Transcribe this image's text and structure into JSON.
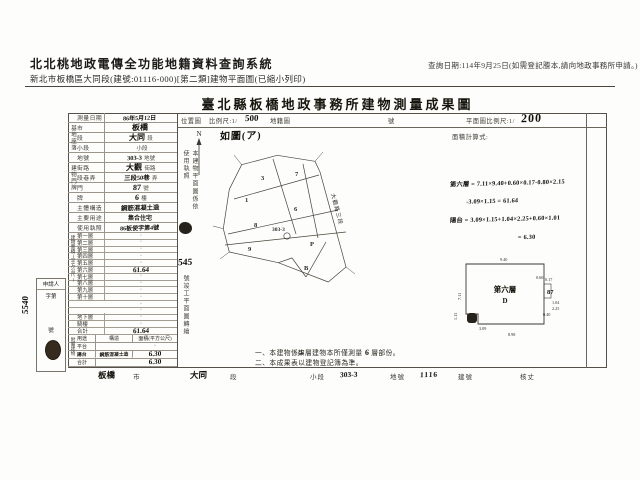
{
  "page": {
    "system_title": "北北桃地政電傳全功能地籍資料查詢系統",
    "query_date": "查詢日期:114年9月25日(如需登記謄本,請向地政事務所申請。)",
    "subtitle": "新北市板橋區大同段(建號:01116-000)[第二類]建物平面圖(已縮小列印)"
  },
  "form": {
    "title": "臺北縣板橋地政事務所建物測量成果圖",
    "header": {
      "location_map": "位置圖",
      "scale_label": "比例尺:1/",
      "scale_value": "500",
      "cadastral_label": "地籍圖",
      "sheet_label": "號",
      "plan_scale_label": "平面圖比例尺:1/",
      "plan_scale_value": "200",
      "calc_label": "面積計算式:"
    }
  },
  "left_table": {
    "groups": {
      "site": "基地座落",
      "door": "建物門牌",
      "area": "建物面積(平方公尺)",
      "annex": "附屬建物"
    },
    "main_rows": [
      {
        "label": "測量日期",
        "value": "86年5月12日",
        "suffix": "",
        "vcls": "hws"
      },
      {
        "label": "市",
        "value": "板橋",
        "suffix": "",
        "vcls": "hw"
      },
      {
        "label": "段",
        "value": "大同",
        "suffix": "段",
        "vcls": "hw"
      },
      {
        "label": "小段",
        "value": "",
        "suffix": "小段",
        "vcls": "hws"
      },
      {
        "label": "地號",
        "value": "303-3",
        "suffix": "地號",
        "vcls": "hwm"
      },
      {
        "label": "街路",
        "value": "大觀",
        "suffix": "街路",
        "vcls": "hw"
      },
      {
        "label": "段巷弄",
        "value": "三段50巷",
        "suffix": "弄",
        "vcls": "hwm"
      },
      {
        "label": "門",
        "value": "87",
        "suffix": "號",
        "vcls": "hw"
      },
      {
        "label": "牌",
        "value": "6",
        "suffix": "樓",
        "vcls": "hw"
      },
      {
        "label": "主體構造",
        "value": "鋼筋混凝土造",
        "suffix": "",
        "vcls": "hwm"
      },
      {
        "label": "主要用途",
        "value": "集合住宅",
        "suffix": "",
        "vcls": "pr2"
      },
      {
        "label": "使用執照",
        "value": "86板使字第4號",
        "suffix": "",
        "vcls": "hws"
      }
    ],
    "floor_rows": [
      {
        "label": "第一層",
        "value": "·",
        "vcls": "dot"
      },
      {
        "label": "第二層",
        "value": "·",
        "vcls": "dot"
      },
      {
        "label": "第三層",
        "value": "·",
        "vcls": "dot"
      },
      {
        "label": "第四層",
        "value": "·",
        "vcls": "dot"
      },
      {
        "label": "第五層",
        "value": "·",
        "vcls": "dot"
      },
      {
        "label": "第六層",
        "value": "61.64",
        "vcls": "hwv"
      },
      {
        "label": "第七層",
        "value": "·",
        "vcls": "dot"
      },
      {
        "label": "第八層",
        "value": "·",
        "vcls": "dot"
      },
      {
        "label": "第九層",
        "value": "·",
        "vcls": "dot"
      },
      {
        "label": "第十層",
        "value": "·",
        "vcls": "dot"
      },
      {
        "label": "",
        "value": "·",
        "vcls": "dot"
      },
      {
        "label": "",
        "value": "·",
        "vcls": "dot"
      },
      {
        "label": "地下層",
        "value": "·",
        "vcls": "dot"
      },
      {
        "label": "騎樓",
        "value": "·",
        "vcls": "dot"
      },
      {
        "label": "合計",
        "value": "61.64",
        "vcls": "hwv"
      }
    ],
    "annex_header": {
      "use": "用途",
      "struct": "構造",
      "area": "面積(平方公尺)"
    },
    "annex_rows": [
      {
        "use": "平台",
        "struct": "",
        "area": "·",
        "ucls": "pr",
        "acls": "dot"
      },
      {
        "use": "陽台",
        "struct": "鋼筋混凝土造",
        "area": "6.30",
        "ucls": "hwt",
        "acls": "hwv"
      },
      {
        "use": "合計",
        "struct": "",
        "area": "6.30",
        "ucls": "pr",
        "acls": "hwv"
      }
    ]
  },
  "map": {
    "north": "N",
    "sketch_note": "如圖(ア)",
    "street": "大觀路三段",
    "subject_parcel": "303-3",
    "parcels": [
      "3",
      "7",
      "1",
      "6",
      "8",
      "303-3",
      "9",
      "P",
      "B"
    ]
  },
  "calc": {
    "line1": "第六層 = 7.11×9.40+0.60×0.17-0.80×2.15",
    "line2": "-3.09×1.15 = 61.64",
    "line3": "陽台 = 3.09×1.15+1.04×2.25+0.60×1.01",
    "line4": "= 6.30"
  },
  "plan": {
    "floor": "第六層",
    "unit": "D",
    "house_no": "87",
    "dim_top": "9.40",
    "dim_left": "7.11",
    "dim_bottom": "8.98",
    "d1": "0.17",
    "d2": "1.04",
    "d3": "2.25",
    "d4": "0.40",
    "d5": "1.15",
    "d6": "3.09",
    "d7": "0.60"
  },
  "side_strip": {
    "text1": "本建物平面圖係依使用執照",
    "number": "545",
    "text2": "號竣工平面圖轉繪"
  },
  "applicant": {
    "title": "申請人",
    "no_prefix": "字第",
    "no_value": "5540",
    "no_suffix": "號"
  },
  "notes": {
    "l1a": "一、本建物係",
    "l1b": "柒",
    "l1c": "層建物本所僅測量",
    "l1d": "6",
    "l1e": "層部份。",
    "l2": "二、本成果表以建物登記簿為準。"
  },
  "footer": {
    "city_v": "板橋",
    "city_l": "市",
    "sec_v": "大同",
    "sec_l": "段",
    "subsec_l": "小段",
    "lot_v": "303-3",
    "lot_l": "地號",
    "bno_v": "1116",
    "bno_l": "建號",
    "check_l": "核丈"
  }
}
